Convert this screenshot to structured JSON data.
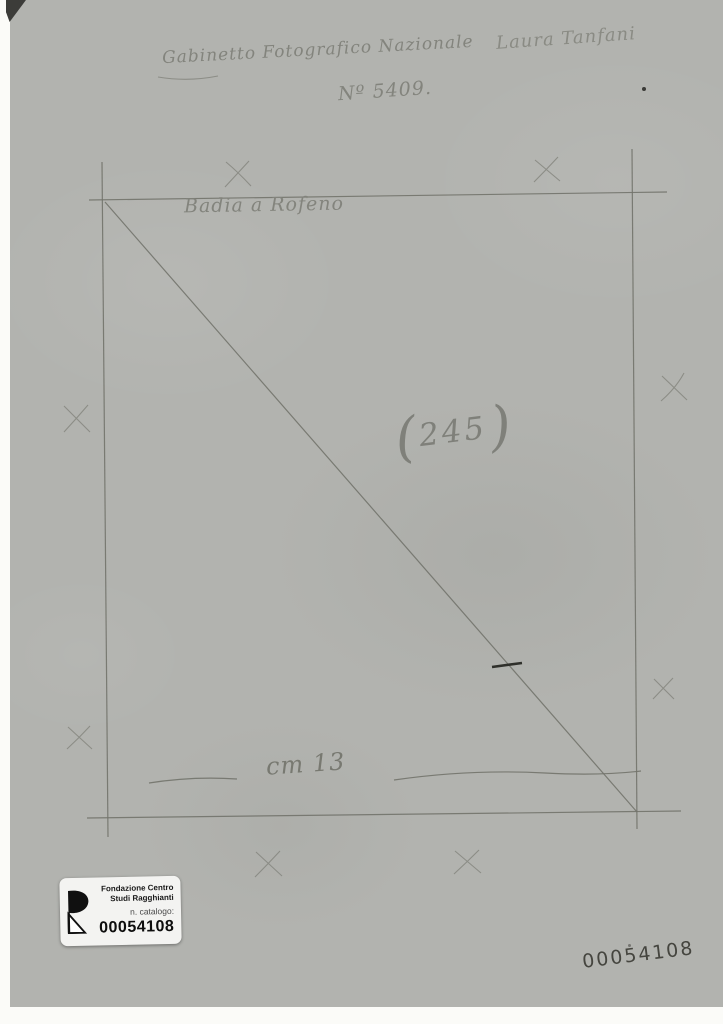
{
  "verso": {
    "institution": "Gabinetto Fotografico Nazionale",
    "negative_number": "Nº 5409.",
    "owner_name": "Laura Tanfani",
    "caption": "Badia a Rofeno",
    "circled": {
      "open": "(",
      "number": "245",
      "close": ")"
    },
    "measurement": "cm 13",
    "handwritten_number": "00054108"
  },
  "label": {
    "org_line1": "Fondazione Centro",
    "org_line2": "Studi Ragghianti",
    "field_label": "n. catalogo:",
    "catalog_number": "00054108"
  },
  "marks": {
    "x_mark_count": 8,
    "pencil_frame": "square with diagonal from top-left to bottom-right"
  },
  "colors": {
    "paper": "#b2b3af",
    "pencil": "#72736c",
    "handwriting": "#83847d",
    "dark_ink": "#2f302b",
    "sticker_background": "#f3f3f1",
    "scan_background": "#fbfbf8"
  }
}
